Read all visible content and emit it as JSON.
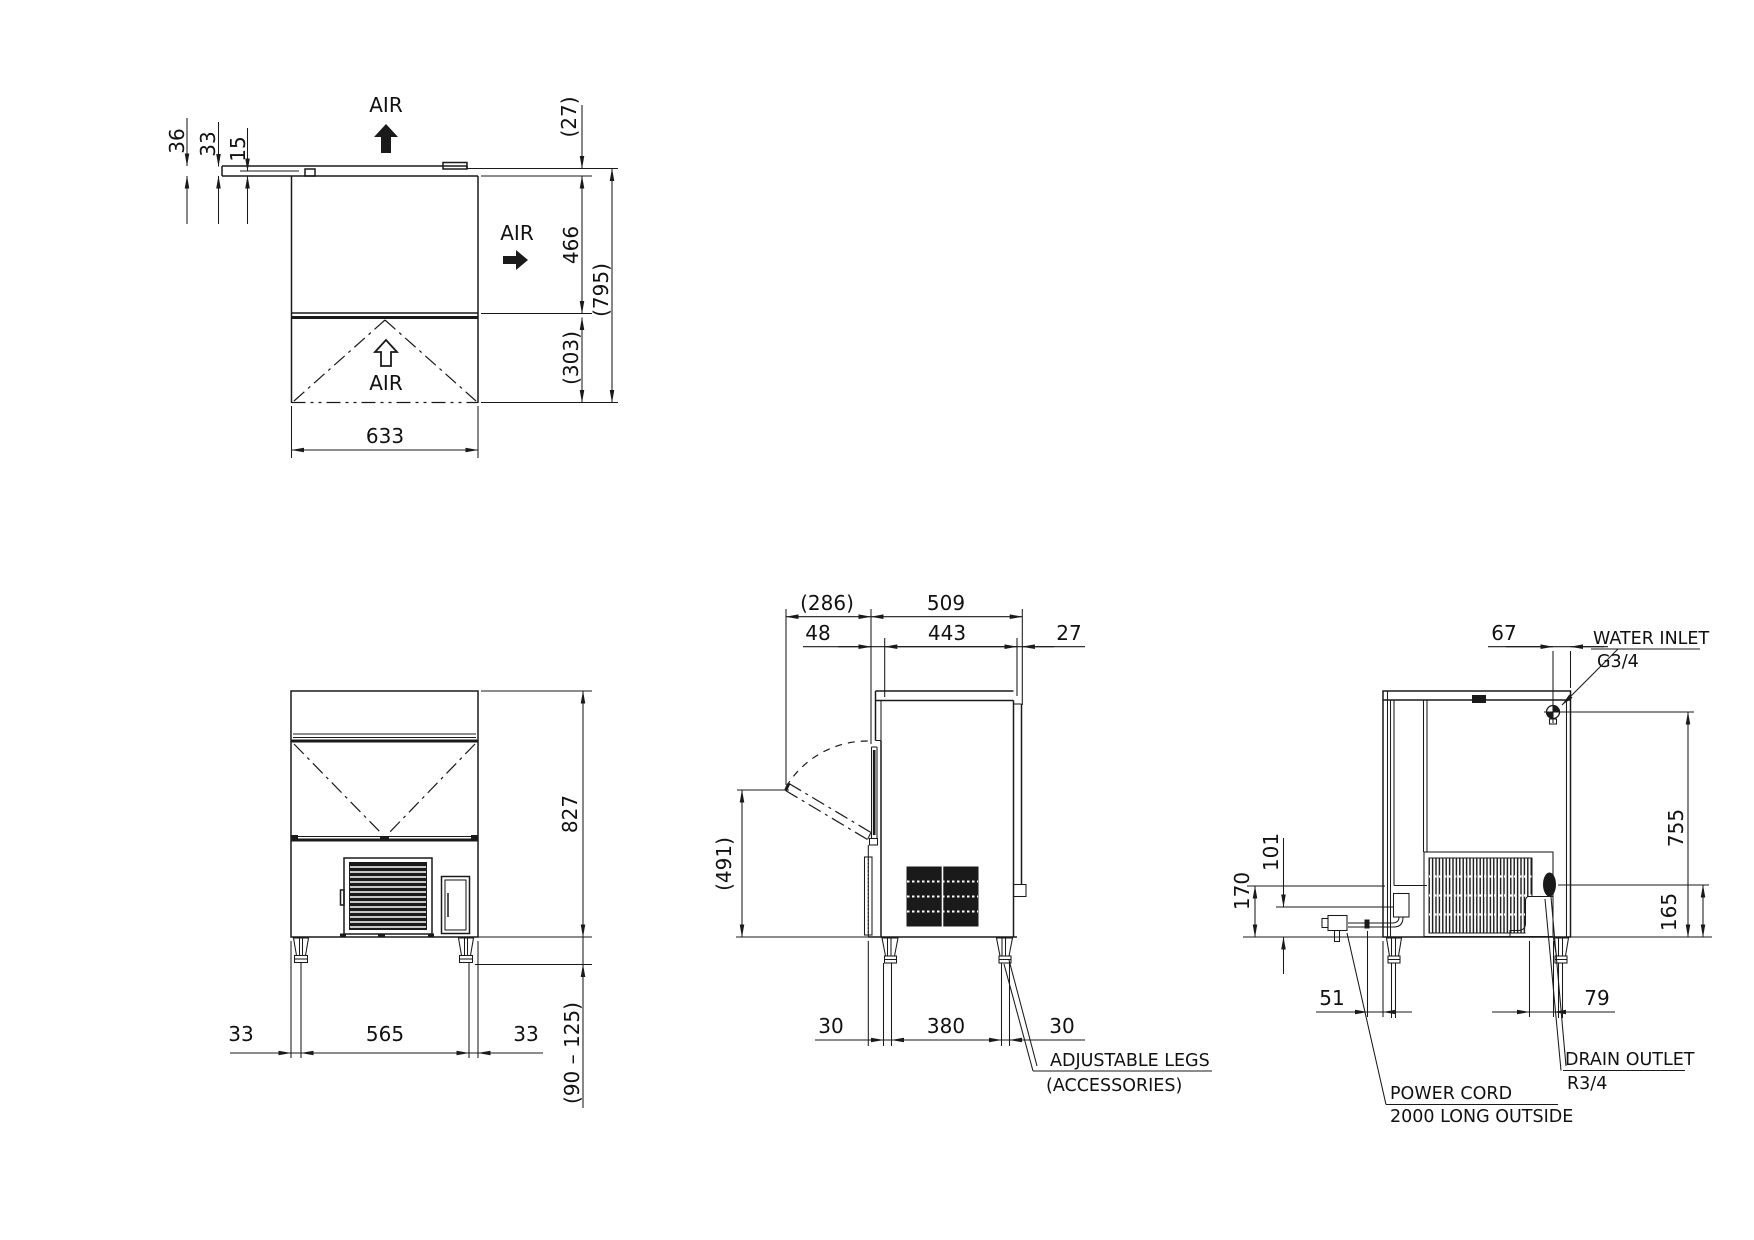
{
  "drawing": {
    "top_view": {
      "air_top": "AIR",
      "air_right": "AIR",
      "air_bottom": "AIR",
      "dim_36": "36",
      "dim_33": "33",
      "dim_15": "15",
      "dim_27": "(27)",
      "dim_466": "466",
      "dim_795": "(795)",
      "dim_303": "(303)",
      "dim_633": "633"
    },
    "front_view": {
      "dim_827": "827",
      "dim_33_left": "33",
      "dim_565": "565",
      "dim_33_right": "33",
      "dim_leg_range": "(90 – 125)"
    },
    "side_view": {
      "dim_286": "(286)",
      "dim_509": "509",
      "dim_48": "48",
      "dim_443": "443",
      "dim_27": "27",
      "dim_491": "(491)",
      "dim_30_front": "30",
      "dim_380": "380",
      "dim_30_rear": "30",
      "note_adjustable_legs": "ADJUSTABLE LEGS",
      "note_accessories": "(ACCESSORIES)"
    },
    "rear_view": {
      "dim_67": "67",
      "dim_755": "755",
      "dim_170": "170",
      "dim_101": "101",
      "dim_165": "165",
      "dim_51": "51",
      "dim_79": "79",
      "label_water_inlet": "WATER INLET",
      "label_water_thread": "G3/4",
      "label_drain_outlet": "DRAIN OUTLET",
      "label_drain_thread": "R3/4",
      "label_power_cord": "POWER CORD",
      "label_power_cord_2": "2000 LONG OUTSIDE"
    }
  }
}
